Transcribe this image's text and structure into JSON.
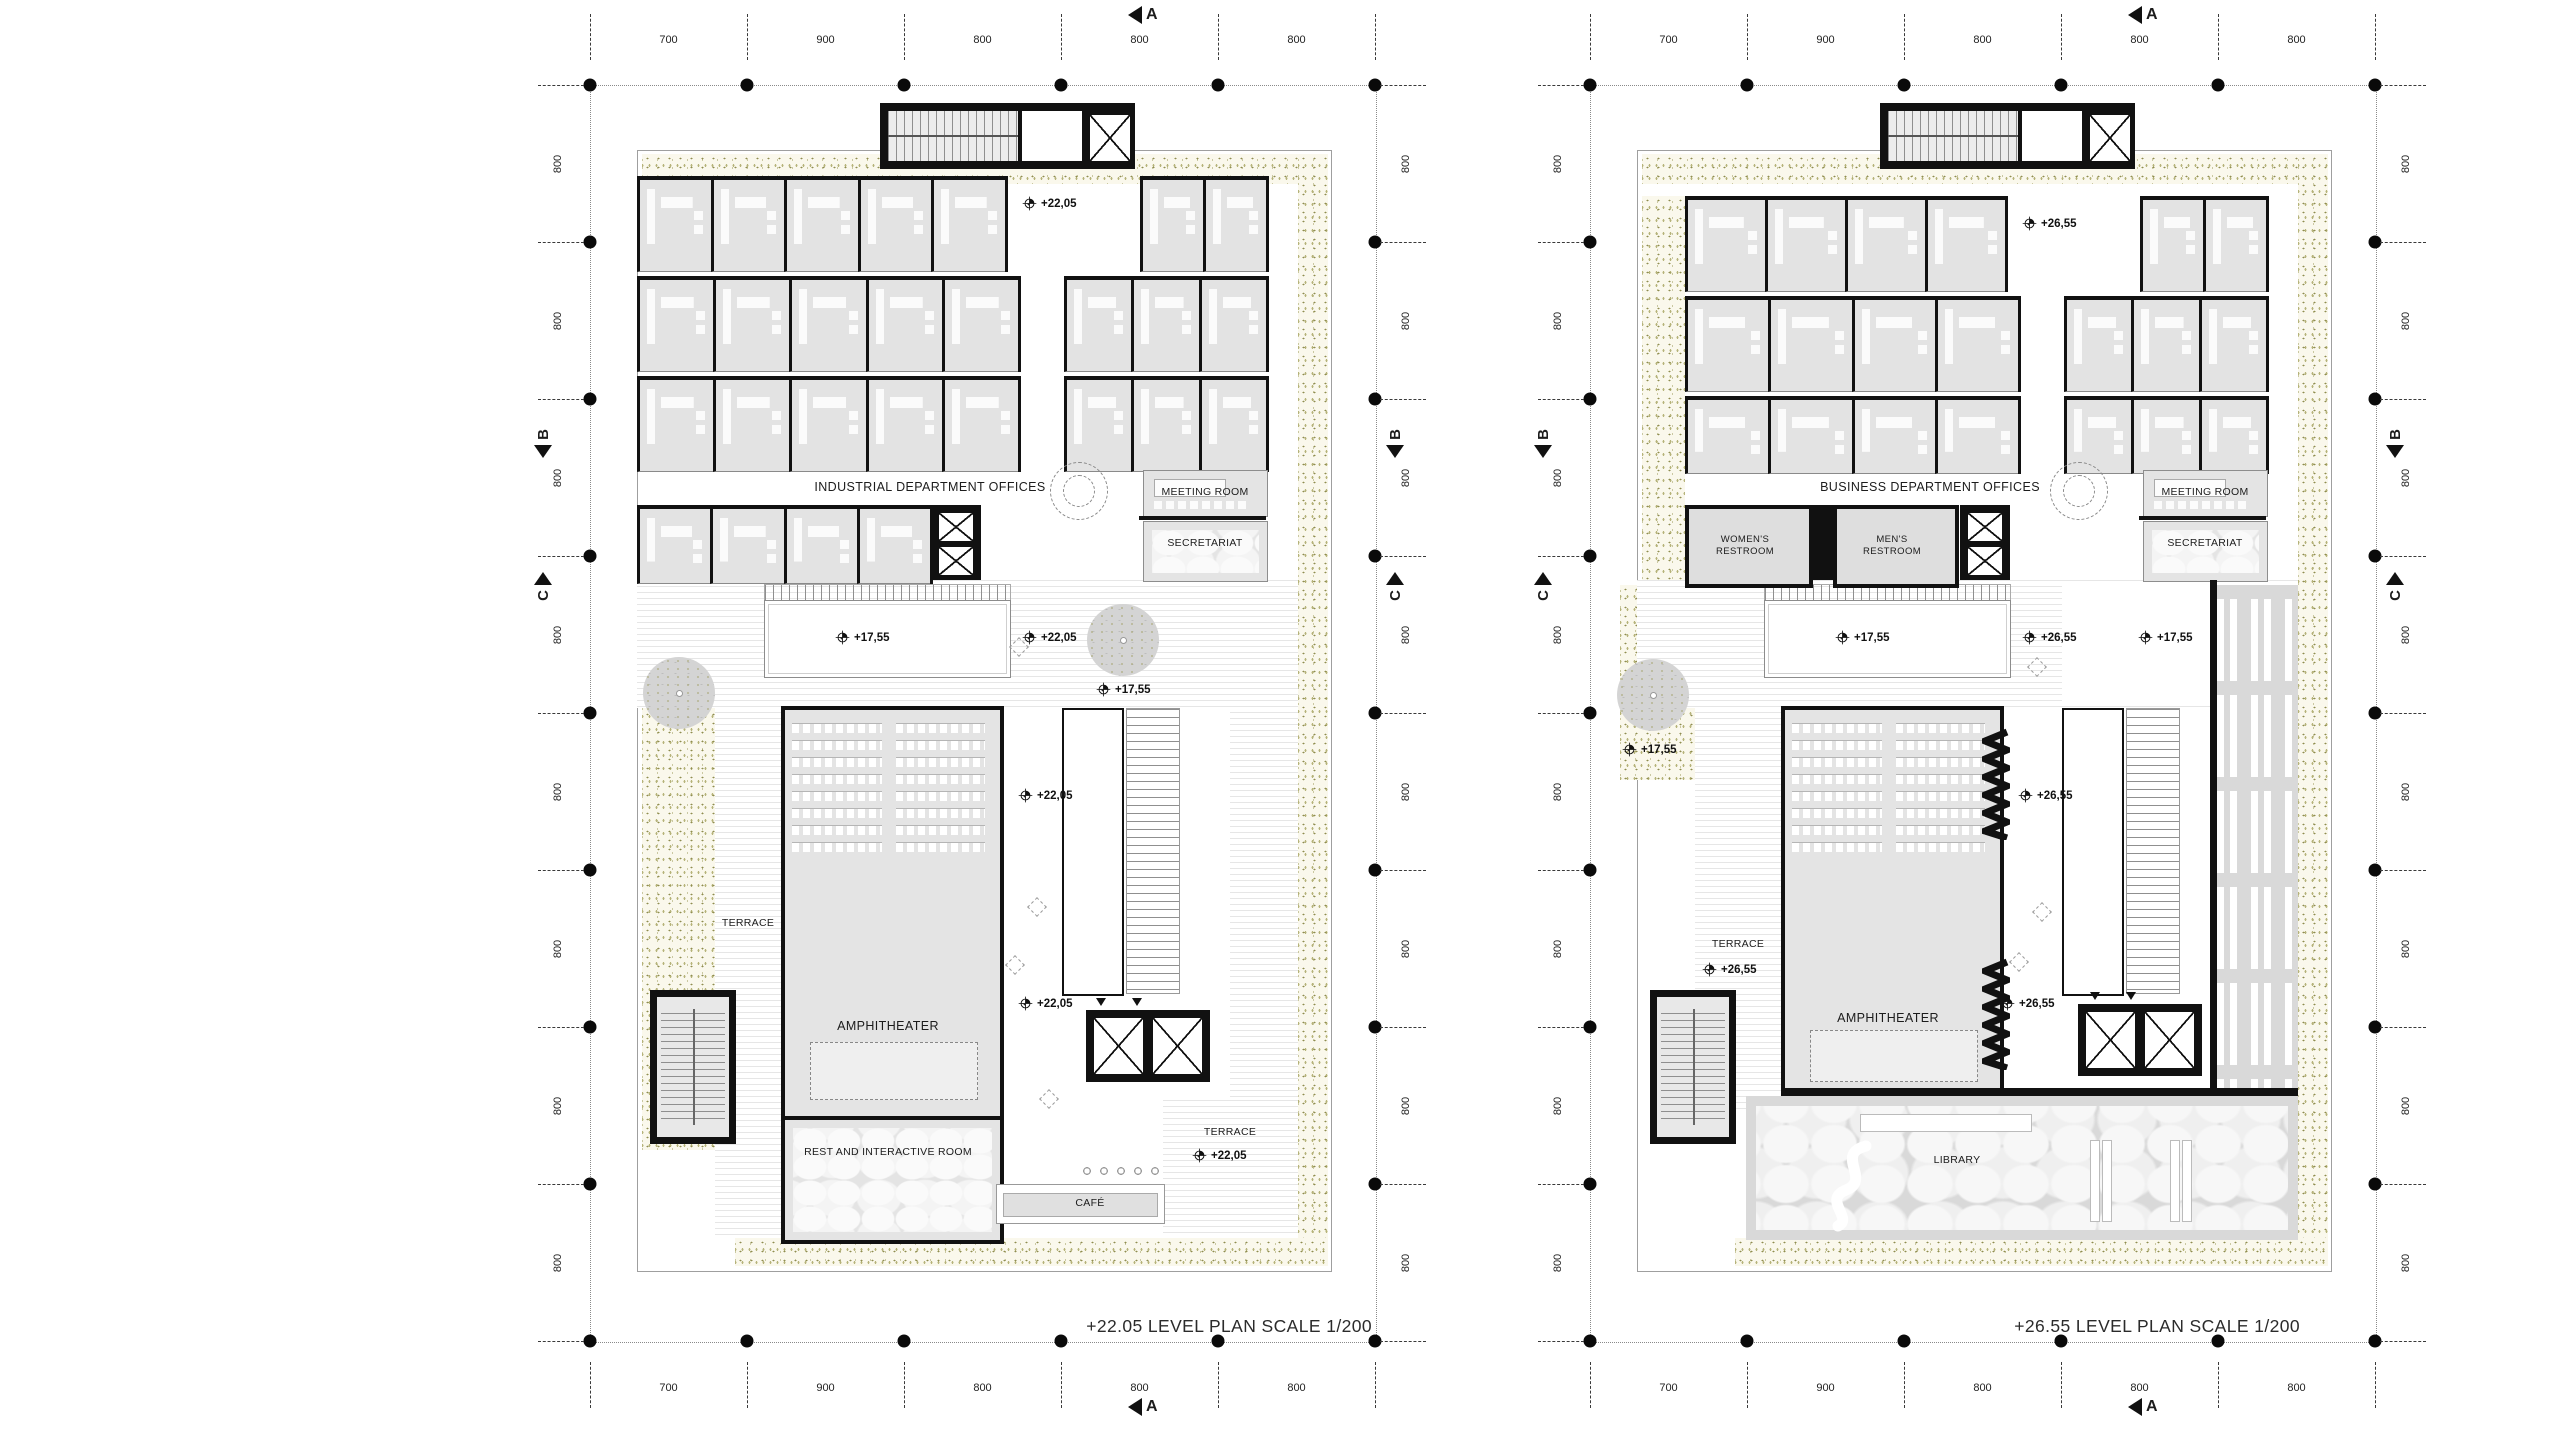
{
  "sheet": {
    "background": "#ffffff",
    "line_color": "#111111",
    "vegetation_color": "#9a9856",
    "room_fill": "#e4e4e4"
  },
  "grid": {
    "top_dims": [
      "700",
      "900",
      "800",
      "800",
      "800"
    ],
    "bottom_dims": [
      "700",
      "900",
      "800",
      "800",
      "800"
    ],
    "left_dims": [
      "800",
      "800",
      "800",
      "800",
      "800",
      "800",
      "800",
      "800"
    ],
    "right_dims": [
      "800",
      "800",
      "800",
      "800",
      "800",
      "800",
      "800",
      "800"
    ],
    "sections": {
      "a": "A",
      "b": "B",
      "c": "C"
    }
  },
  "plans": {
    "left": {
      "caption": "+22.05 LEVEL PLAN SCALE 1/200",
      "levels": {
        "core": "+22,05",
        "skylight": "+17,55",
        "mid": "+22,05",
        "tree": "+17,55",
        "lobby_upper": "+22,05",
        "lobby_lower": "+22,05",
        "terrace_right": "+22,05"
      },
      "rooms": {
        "offices": "INDUSTRIAL DEPARTMENT OFFICES",
        "meeting": "MEETING ROOM",
        "secretariat": "SECRETARIAT",
        "terrace_left": "TERRACE",
        "amphitheater": "AMPHITHEATER",
        "rest": "REST AND INTERACTIVE ROOM",
        "cafe": "CAFÉ",
        "terrace_right": "TERRACE"
      }
    },
    "right": {
      "caption": "+26.55 LEVEL PLAN SCALE 1/200",
      "levels": {
        "core": "+26,55",
        "skylight": "+17,55",
        "mid": "+26,55",
        "mid_right": "+17,55",
        "ground_tree": "+17,55",
        "terrace_left": "+26,55",
        "lobby_upper": "+26,55",
        "lobby_lower": "+26,55"
      },
      "rooms": {
        "offices": "BUSINESS DEPARTMENT OFFICES",
        "womens": "WOMEN'S RESTROOM",
        "mens": "MEN'S RESTROOM",
        "meeting": "MEETING ROOM",
        "secretariat": "SECRETARIAT",
        "terrace_left": "TERRACE",
        "amphitheater": "AMPHITHEATER",
        "library": "LIBRARY"
      }
    }
  }
}
